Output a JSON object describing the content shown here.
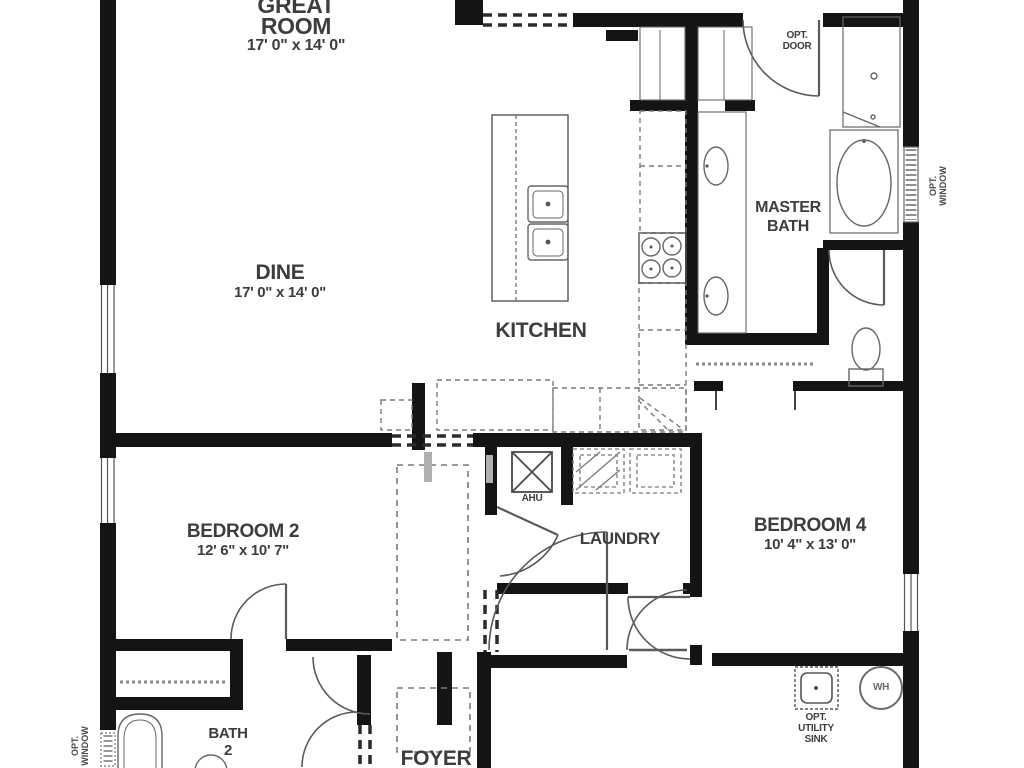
{
  "plan": {
    "rooms": {
      "great_room": {
        "line1": "GREAT",
        "line2": "ROOM",
        "dims": "17' 0\" x 14' 0\""
      },
      "dine": {
        "name": "DINE",
        "dims": "17' 0\" x 14' 0\""
      },
      "kitchen": {
        "name": "KITCHEN"
      },
      "master_bath": {
        "line1": "MASTER",
        "line2": "BATH"
      },
      "bedroom2": {
        "name": "BEDROOM 2",
        "dims": "12' 6\" x 10' 7\""
      },
      "bedroom4": {
        "name": "BEDROOM 4",
        "dims": "10' 4\" x 13' 0\""
      },
      "laundry": {
        "name": "LAUNDRY"
      },
      "bath2": {
        "line1": "BATH",
        "line2": "2"
      },
      "foyer": {
        "name": "FOYER"
      },
      "ahu": {
        "name": "AHU"
      }
    },
    "annotations": {
      "opt_door": {
        "line1": "OPT.",
        "line2": "DOOR"
      },
      "opt_window_right": {
        "line1": "OPT.",
        "line2": "WINDOW"
      },
      "opt_window_left": {
        "line1": "OPT.",
        "line2": "WINDOW"
      },
      "opt_utility_sink": {
        "line1": "OPT.",
        "line2": "UTILITY",
        "line3": "SINK"
      },
      "water_heater": {
        "label": "WH"
      }
    },
    "colors": {
      "wall": "#141414",
      "fixture": "#666666",
      "dashed": "#7a7a7a",
      "text": "#3d3d3d",
      "background": "#ffffff"
    }
  }
}
